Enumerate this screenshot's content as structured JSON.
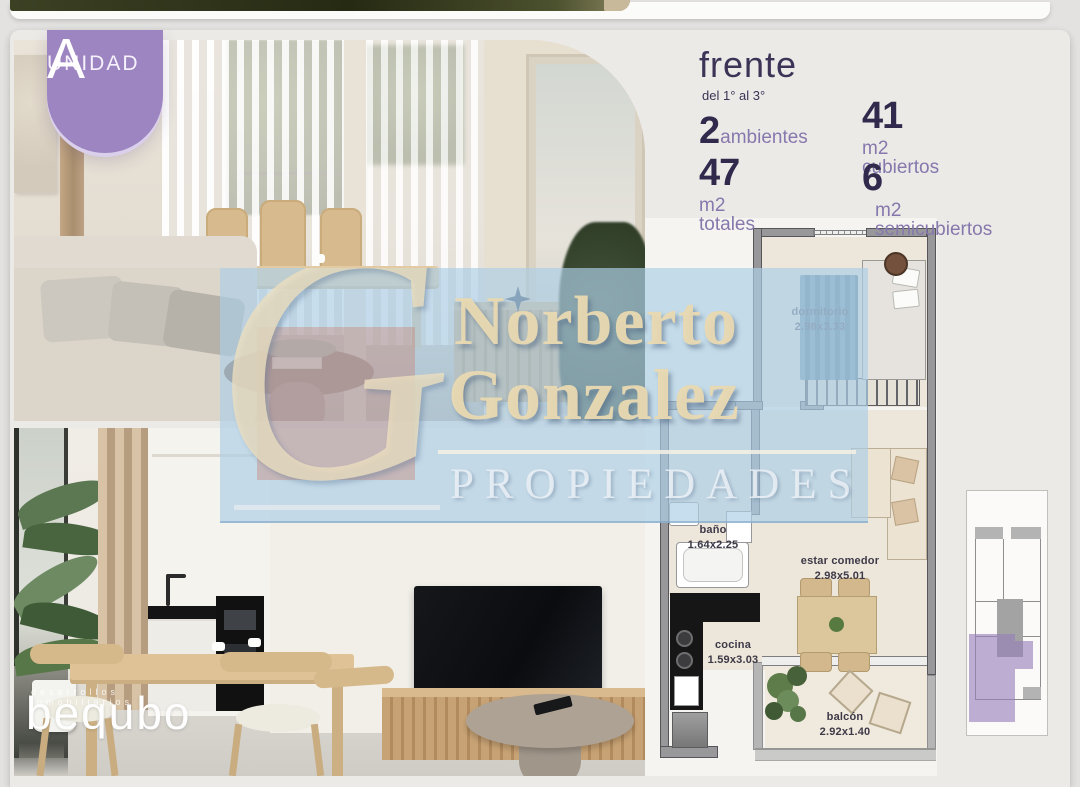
{
  "page": {
    "background": "#e3e2e0",
    "card_background": "#eceae7",
    "accent_purple": "#9c85c0",
    "text_dark": "#3c3356",
    "text_purple": "#8678ad"
  },
  "badge": {
    "label": "UNIDAD",
    "letter": "A"
  },
  "header": {
    "title": "frente",
    "subtitle": "del 1° al 3°"
  },
  "stats": [
    {
      "value": "2",
      "label": "ambientes"
    },
    {
      "value": "47",
      "label": "m2 totales"
    },
    {
      "value": "41",
      "label": "m2 cubiertos"
    },
    {
      "value": "6",
      "label": "m2 semicubiertos"
    }
  ],
  "watermark": {
    "monogram": "G",
    "line1": "Norberto",
    "line2": "Gonzalez",
    "line3": "PROPIEDADES",
    "band_color": "rgba(173,206,230,0.68)",
    "text_color": "#e9d9b1"
  },
  "floorplan": {
    "highlight_color": "#a08cc6",
    "rooms": [
      {
        "name": "dormitorio",
        "dims": "2.98x3.33"
      },
      {
        "name": "baño",
        "dims": "1.64x2.25"
      },
      {
        "name": "estar comedor",
        "dims": "2.98x5.01"
      },
      {
        "name": "cocina",
        "dims": "1.59x3.03"
      },
      {
        "name": "balcón",
        "dims": "2.92x1.40"
      }
    ]
  },
  "brand": {
    "name": "bequbo",
    "tagline": "desarrollos inmobiliarios"
  }
}
